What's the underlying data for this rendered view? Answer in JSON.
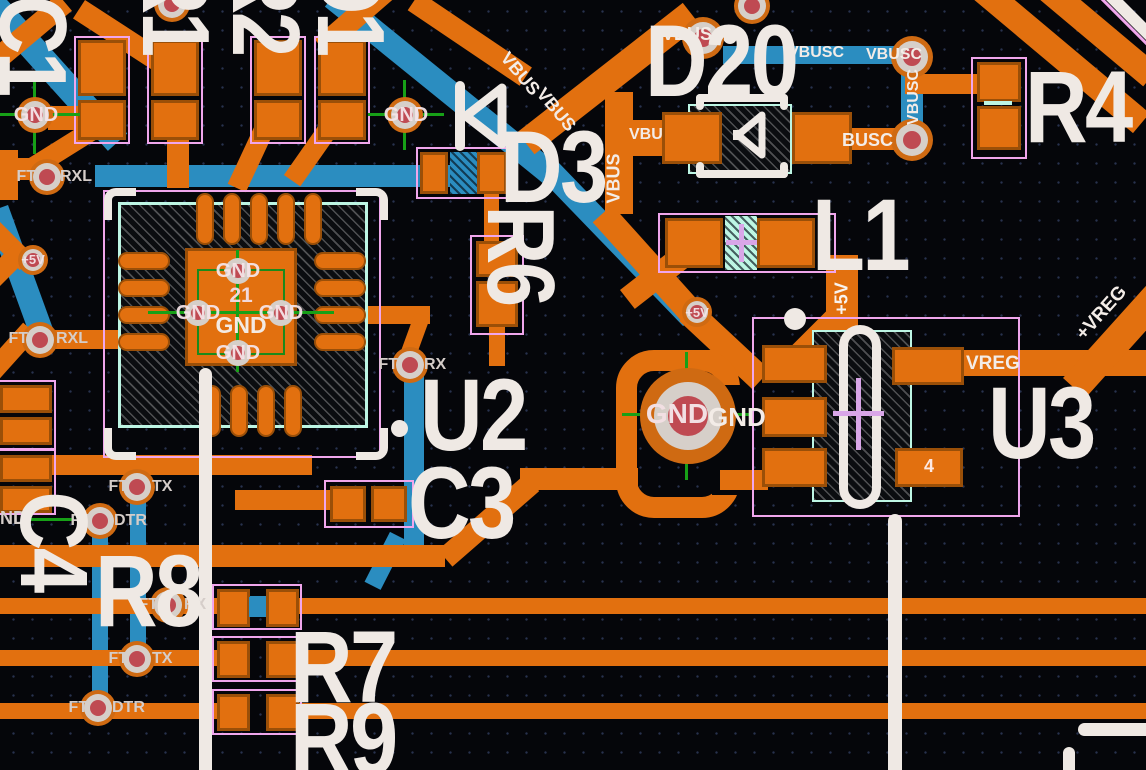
{
  "board": {
    "colors": {
      "copper_top": "#e2700f",
      "copper_bottom": "#2b8dc0",
      "silkscreen": "#efe9e4",
      "courtyard": "#f0a6ec",
      "assembly": "#bdf6e4",
      "via_core": "#bf4a52",
      "crosshair": "#17a017",
      "polarity_mark": "#d9a6e8"
    }
  },
  "designators": {
    "c1": "C1",
    "top_ref_1": "R1",
    "top_ref_2": "R2",
    "top_ref_3": "D1",
    "d20": "D20",
    "d3": "D3",
    "r4": "R4",
    "r6": "R6",
    "l1": "L1",
    "u2": "U2",
    "u3": "U3",
    "c3": "C3",
    "c4": "C4",
    "r8": "R8",
    "r7": "R7",
    "r9": "R9"
  },
  "net_labels": {
    "vbus": "VBUS",
    "vbu": "VBU",
    "vbusc": "VBUSC",
    "busc": "BUSC",
    "gnd": "GND",
    "nd": "ND",
    "plus5v": "+5V",
    "vreg": "VREG",
    "plus_vreg": "+VREG",
    "ft": "FT",
    "rxl": "RXL",
    "rx": "RX",
    "tx": "TX",
    "dtr": "DTR"
  },
  "pad_labels": {
    "u2_center_pin": "21",
    "u2_center_net": "GND",
    "u3_pad4": "4",
    "gnd_pad": "GND"
  }
}
